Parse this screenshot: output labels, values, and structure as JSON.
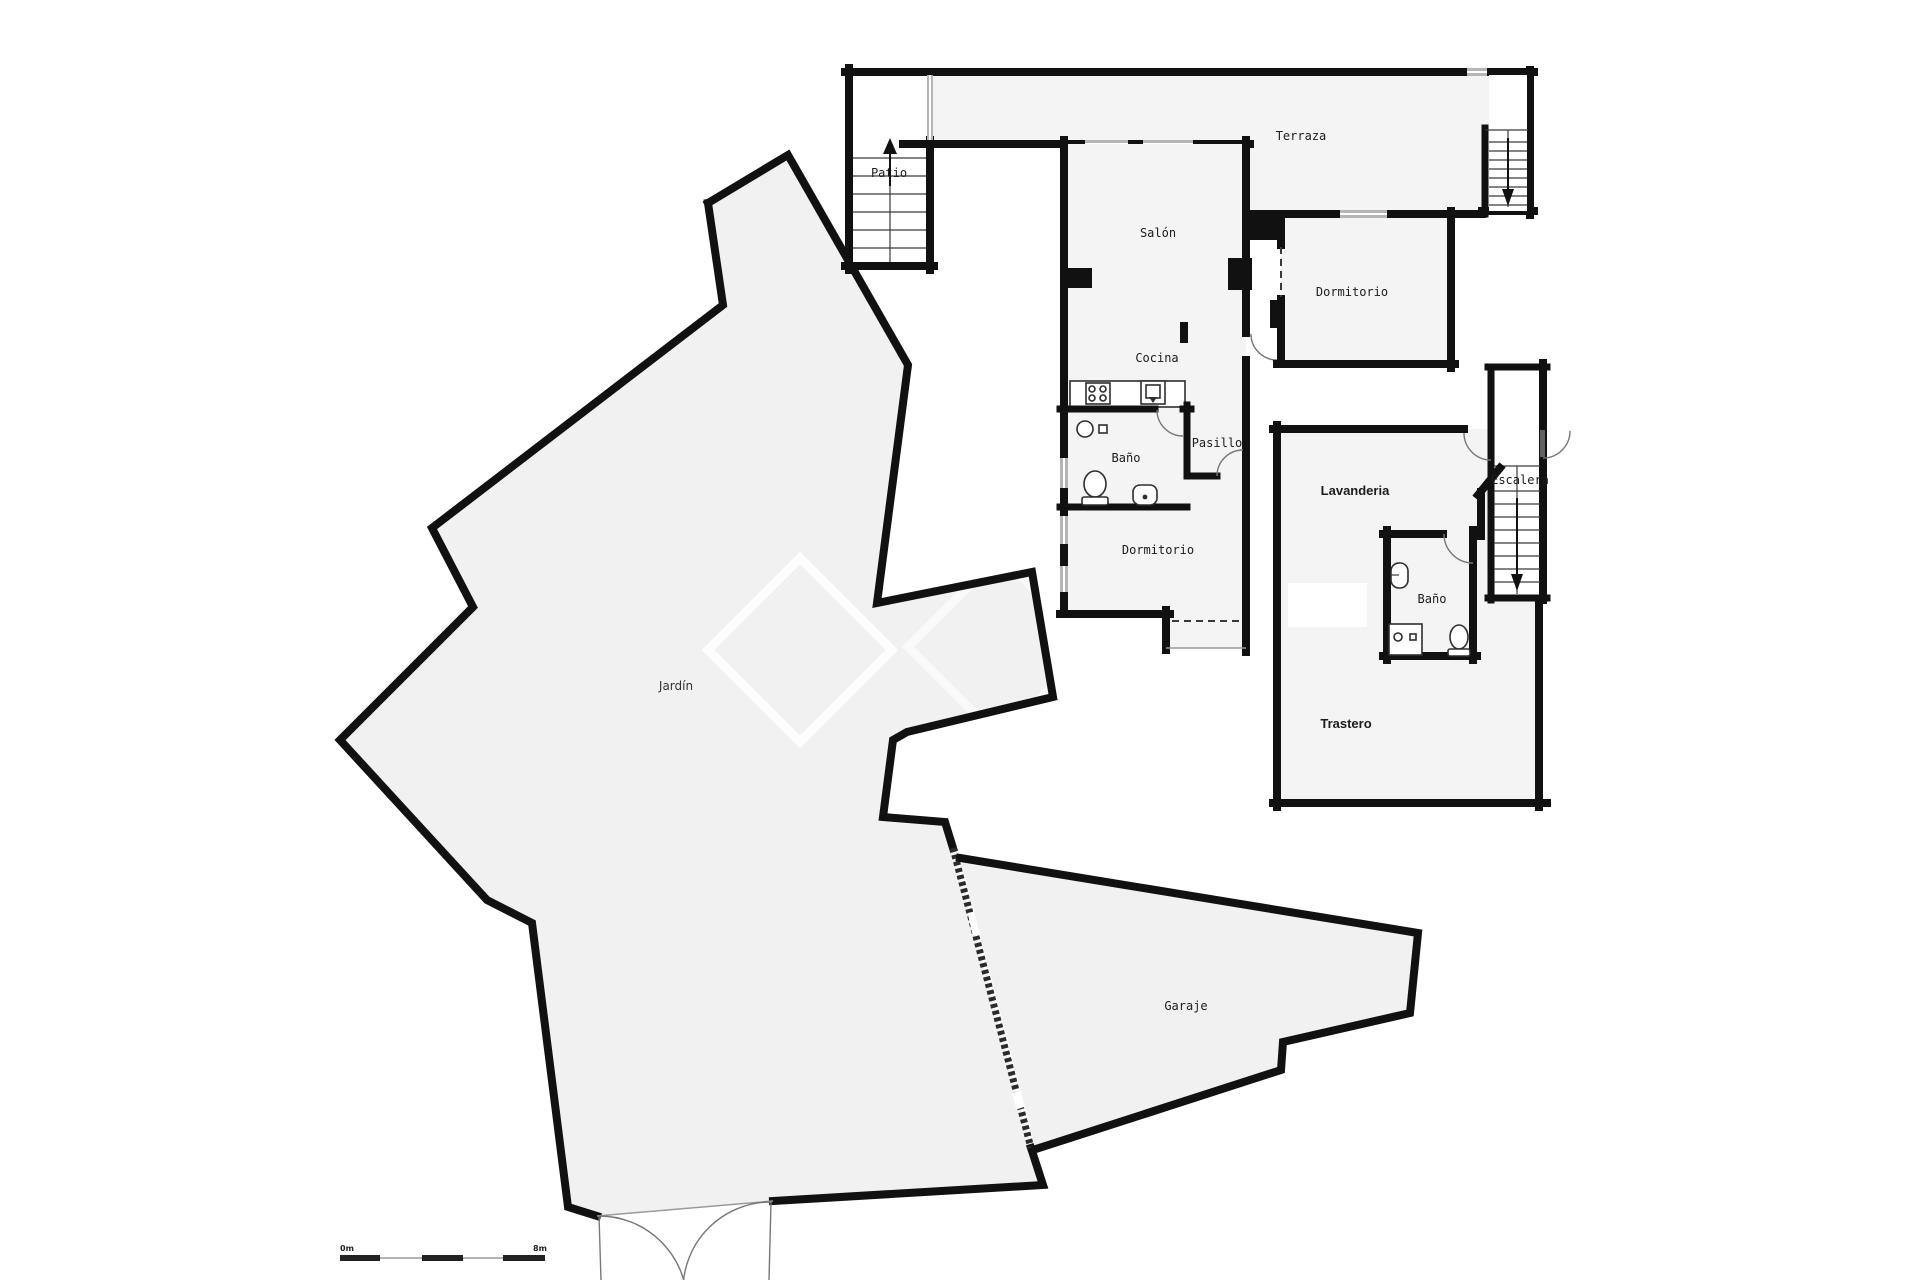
{
  "colors": {
    "background": "#ffffff",
    "wall": "#111111",
    "room_floor": "#f4f4f5",
    "outdoor_floor": "#f1f1f2",
    "window": "#b5b5b5",
    "door_arc": "#777777",
    "text": "#1c1c1c"
  },
  "labels": {
    "patio": "Patio",
    "terraza": "Terraza",
    "salon": "Salón",
    "dormitorio_top": "Dormitorio",
    "cocina": "Cocina",
    "bano_main": "Baño",
    "pasillo": "Pasillo",
    "dormitorio_mid": "Dormitorio",
    "lavanderia": "Lavanderia",
    "escalera": "Escalera",
    "bano_upper": "Baño",
    "trastero": "Trastero",
    "jardin": "Jardín",
    "garaje": "Garaje"
  },
  "scale_bar": {
    "start": "0m",
    "end": "8m"
  },
  "icons": {
    "patio_stairs_arrow": "arrow-up",
    "terrace_stairs_arrow": "arrow-down",
    "escalera_arrow": "arrow-down"
  }
}
